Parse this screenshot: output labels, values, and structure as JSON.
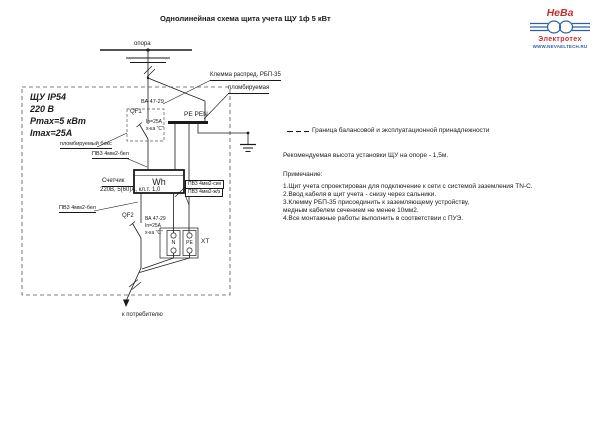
{
  "colors": {
    "line": "#1a1a1a",
    "dash": "#555555",
    "logo_red": "#c62f2f",
    "logo_blue": "#2d5fa8"
  },
  "title": "Однолинейная схема щита учета ЩУ 1ф 5 кВт",
  "logo": {
    "name_top": "НеВа",
    "name_bottom": "Электротех",
    "url": "WWW.NEVAELTECH.RU"
  },
  "diagram": {
    "pole_label": "опора",
    "clamp_callout": {
      "line1": "Клемма распред. РБП-35",
      "line2": "пломбируемая"
    },
    "enclosure": {
      "line1": "ЩУ IP54",
      "line2": "220 В",
      "line3": "Pmax=5 кВт",
      "line4": "Imax=25А"
    },
    "sealed_box_label": "пломбируемый бокс",
    "qf1": {
      "id": "QF1",
      "type": "ВА 47-29",
      "current": "In=25A",
      "curve": "х-ка \"С\""
    },
    "busbar_label": "PE PEN",
    "meter": {
      "symbol": "Wh",
      "label": "Счетчик",
      "spec": "220В, 5(60)А, кл.т. 1,0"
    },
    "wires": {
      "bel_top": "ПВ3 4мм2-бел",
      "bel_bottom": "ПВ3 4мм2-бел",
      "sin": "ПВ3 4мм2-син",
      "zh": "ПВ3 4мм2-ж/з"
    },
    "qf2": {
      "id": "QF2",
      "type": "ВА 47-29",
      "current": "In=25A",
      "curve": "х-ка \"С\""
    },
    "xt": {
      "id": "XT",
      "n": "N",
      "pe": "PE"
    },
    "consumer_label": "к потребителю"
  },
  "legend": {
    "boundary": "Граница балансовой и эксплуатационной принадлежности",
    "height_note": "Рекомендуемая высота установки ЩУ на опоре - 1,5м."
  },
  "notes": {
    "heading": "Примечание:",
    "items": [
      "1.Щит учета спроектирован для подключение к сети с системой заземления TN-C.",
      "2.Ввод кабеля в щит учета - снизу через сальники.",
      "3.Клемму РБП-35 присоединить к заземляющему устройству,",
      " медным кабелем сечением не менее 10мм2.",
      "4.Все монтажные работы выполнить в соответствии с ПУЭ."
    ]
  }
}
